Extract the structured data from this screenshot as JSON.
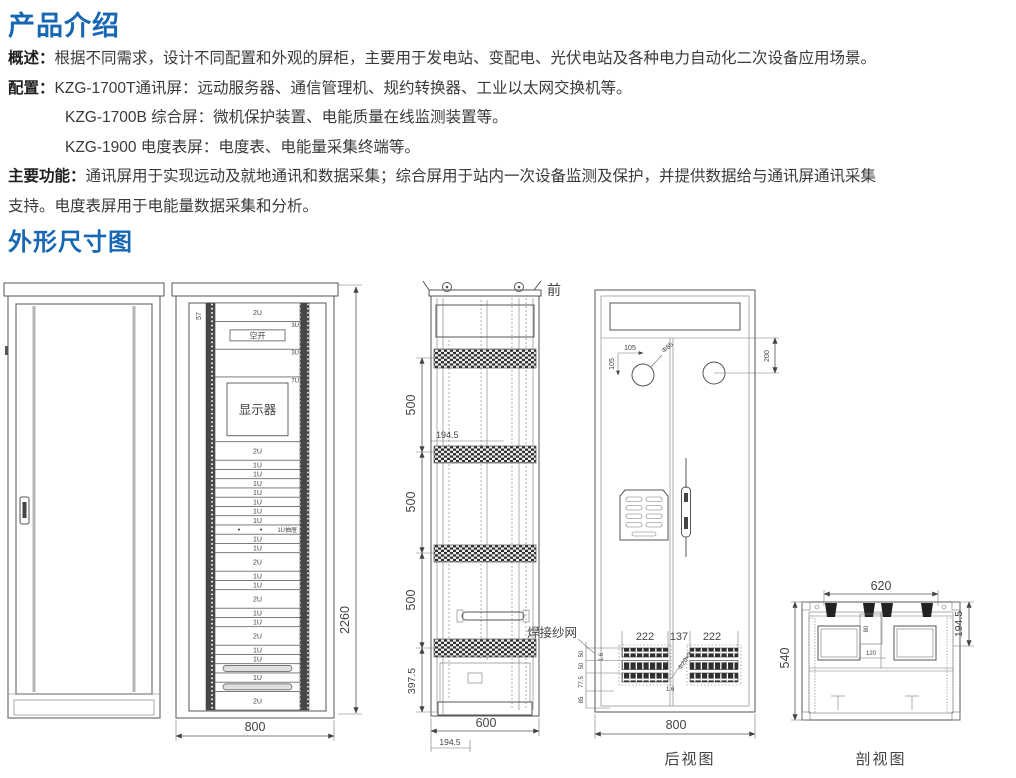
{
  "page": {
    "bg": "#ffffff",
    "accent_blue": "#1767b3",
    "line_color": "#555555",
    "text_color": "#3a3a3a"
  },
  "intro": {
    "title": "产品介绍",
    "overview_label": "概述：",
    "overview_text": "根据不同需求，设计不同配置和外观的屏柜，主要用于发电站、变配电、光伏电站及各种电力自动化二次设备应用场景。",
    "config_label": "配置：",
    "config_lines": [
      "KZG-1700T通讯屏：远动服务器、通信管理机、规约转换器、工业以太网交换机等。",
      "KZG-1700B 综合屏：微机保护装置、电能质量在线监测装置等。",
      "KZG-1900 电度表屏：电度表、电能量采集终端等。"
    ],
    "functions_label": "主要功能：",
    "functions_line1": "通讯屏用于实现远动及就地通讯和数据采集；综合屏用于站内一次设备监测及保护，并提供数据给与通讯屏通讯采集",
    "functions_line2": "支持。电度表屏用于电能量数据采集和分析。"
  },
  "dimensions_section": {
    "title": "外形尺寸图",
    "front_open_view": {
      "top_left_dim": "57",
      "height_dim": "2260",
      "width_dim": "800",
      "panels": [
        {
          "label": "2U",
          "u": 2,
          "type": "plain"
        },
        {
          "label": "空开",
          "u": 3,
          "type": "breaker",
          "side": "3U"
        },
        {
          "label": "",
          "u": 3,
          "type": "plain",
          "side": "3U"
        },
        {
          "label": "显示器",
          "u": 7,
          "type": "display",
          "side": "7U"
        },
        {
          "label": "2U",
          "u": 2,
          "type": "plain"
        },
        {
          "label": "1U",
          "u": 1,
          "type": "plain"
        },
        {
          "label": "1U",
          "u": 1,
          "type": "plain"
        },
        {
          "label": "1U",
          "u": 1,
          "type": "plain"
        },
        {
          "label": "1U",
          "u": 1,
          "type": "plain"
        },
        {
          "label": "1U",
          "u": 1,
          "type": "plain"
        },
        {
          "label": "1U",
          "u": 1,
          "type": "plain"
        },
        {
          "label": "1U",
          "u": 1,
          "type": "plain"
        },
        {
          "label": "1U抽屉",
          "u": 1,
          "type": "drawer"
        },
        {
          "label": "1U",
          "u": 1,
          "type": "plain"
        },
        {
          "label": "1U",
          "u": 1,
          "type": "plain"
        },
        {
          "label": "2U",
          "u": 2,
          "type": "plain"
        },
        {
          "label": "1U",
          "u": 1,
          "type": "plain"
        },
        {
          "label": "1U",
          "u": 1,
          "type": "plain"
        },
        {
          "label": "2U",
          "u": 2,
          "type": "plain"
        },
        {
          "label": "1U",
          "u": 1,
          "type": "plain"
        },
        {
          "label": "1U",
          "u": 1,
          "type": "plain"
        },
        {
          "label": "2U",
          "u": 2,
          "type": "plain"
        },
        {
          "label": "1U",
          "u": 1,
          "type": "plain"
        },
        {
          "label": "1U",
          "u": 1,
          "type": "plain"
        },
        {
          "label": "",
          "u": 1,
          "type": "tray"
        },
        {
          "label": "1U",
          "u": 1,
          "type": "plain"
        },
        {
          "label": "",
          "u": 1,
          "type": "tray"
        },
        {
          "label": "2U",
          "u": 2,
          "type": "plain"
        }
      ]
    },
    "side_view": {
      "front_label": "前",
      "left_dims": [
        "500",
        "500",
        "500",
        "397.5"
      ],
      "mid_dim": "194.5",
      "width_dim": "600",
      "offset_dim": "194.5"
    },
    "rear_view": {
      "caption": "后视图",
      "hole_dim_h": "105",
      "hole_dim_v": "105",
      "hole_dia": "Φ85",
      "top_offset_dim": "200",
      "mesh_note": "焊接纱网",
      "mesh_dims": [
        "222",
        "137",
        "222"
      ],
      "mesh_dia": "Φ20×3",
      "mesh_thk1": "1.6",
      "mesh_thk2": "1.6",
      "ladder_dims": [
        "50",
        "50",
        "77.5",
        "85"
      ],
      "width_dim": "800"
    },
    "section_view": {
      "caption": "剖视图",
      "top_dim": "620",
      "right_dim": "194.5",
      "left_dim": "540",
      "inner_dim_v": "80",
      "inner_dim_h": "120"
    }
  }
}
